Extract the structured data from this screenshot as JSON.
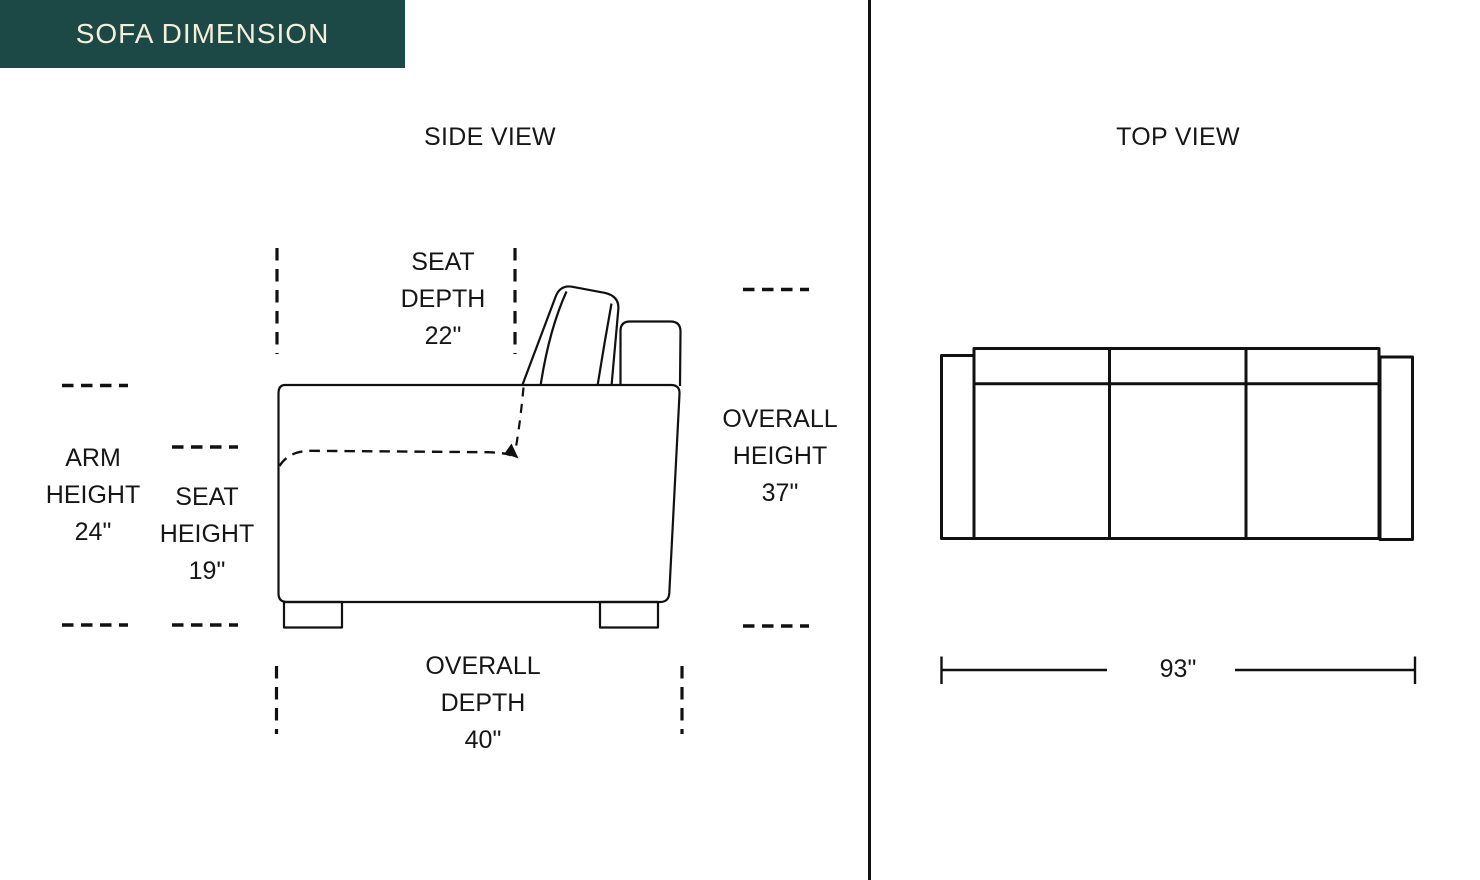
{
  "page": {
    "title_badge": "SOFA DIMENSION",
    "colors": {
      "badge_background": "#1C4945",
      "badge_text": "#F4EEDA",
      "line_color": "#111111",
      "page_background": "#FFFFFF"
    }
  },
  "side_view": {
    "title": "SIDE VIEW",
    "dimensions": {
      "seat_depth": {
        "label": "SEAT DEPTH",
        "value": "22\""
      },
      "arm_height": {
        "label": "ARM HEIGHT",
        "value": "24\""
      },
      "seat_height": {
        "label": "SEAT HEIGHT",
        "value": "19\""
      },
      "overall_height": {
        "label": "OVERALL HEIGHT",
        "value": "37\""
      },
      "overall_depth": {
        "label": "OVERALL DEPTH",
        "value": "40\""
      }
    }
  },
  "top_view": {
    "title": "TOP VIEW",
    "dimensions": {
      "overall_width": {
        "value": "93\""
      }
    }
  }
}
